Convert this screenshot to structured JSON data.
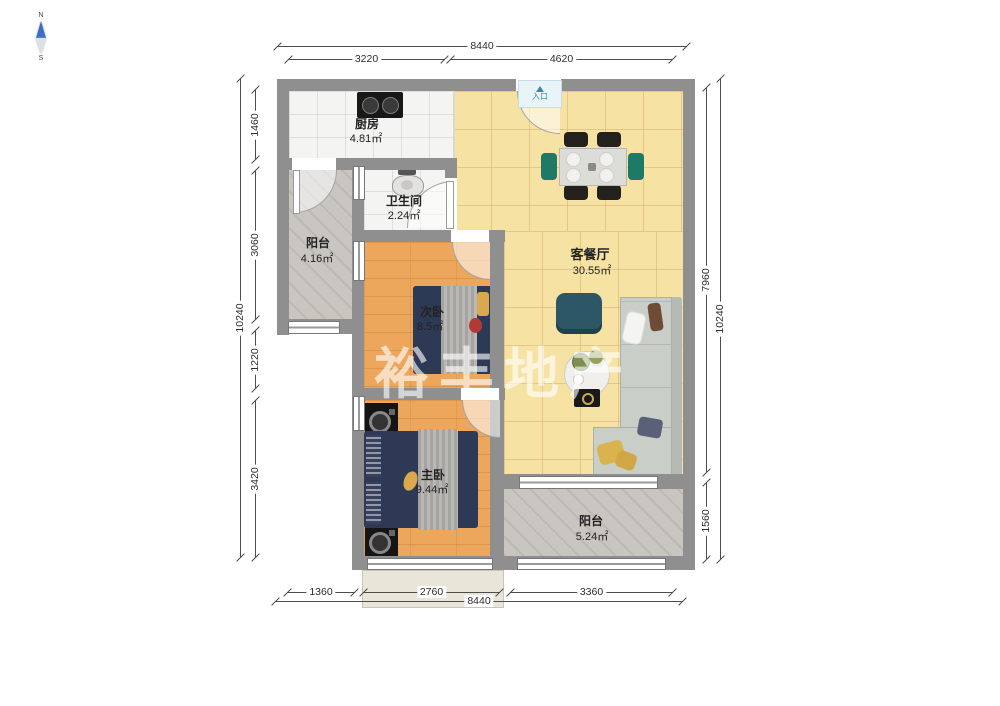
{
  "title": "两室户型图",
  "watermark": "裕丰地产",
  "entrance_label": "入口",
  "compass": {
    "north_label": "N",
    "south_label": "S"
  },
  "rooms": [
    {
      "id": "kitchen",
      "name": "厨房",
      "area": "4.81㎡"
    },
    {
      "id": "bathroom",
      "name": "卫生间",
      "area": "2.24㎡"
    },
    {
      "id": "balcony-left",
      "name": "阳台",
      "area": "4.16㎡"
    },
    {
      "id": "living-dining",
      "name": "客餐厅",
      "area": "30.55㎡"
    },
    {
      "id": "second-bedroom",
      "name": "次卧",
      "area": "8.5㎡"
    },
    {
      "id": "master-bedroom",
      "name": "主卧",
      "area": "9.44㎡"
    },
    {
      "id": "balcony-bottom",
      "name": "阳台",
      "area": "5.24㎡"
    }
  ],
  "dimensions": {
    "top": {
      "overall": "8440",
      "segments": [
        "3220",
        "4620"
      ]
    },
    "bottom": {
      "overall": "8440",
      "segments": [
        "1360",
        "2760",
        "3360"
      ]
    },
    "left": {
      "overall": "10240",
      "segments": [
        "1460",
        "3060",
        "1220",
        "3420"
      ]
    },
    "right": {
      "overall": "10240",
      "segments": [
        "7960",
        "1560"
      ]
    }
  },
  "colors": {
    "wall": "#8f8f8f",
    "living_floor": "#f6e2a2",
    "wood_floor": "#eca75d",
    "balcony_floor": "#c9c6c2",
    "bed": "#2e3a55",
    "sofa": "#c9cec9",
    "accent_teal": "#2d5766",
    "chair_green": "#1e7a66",
    "entrance_text": "#2e8fa0",
    "compass_needle": "#3d6ec2"
  }
}
